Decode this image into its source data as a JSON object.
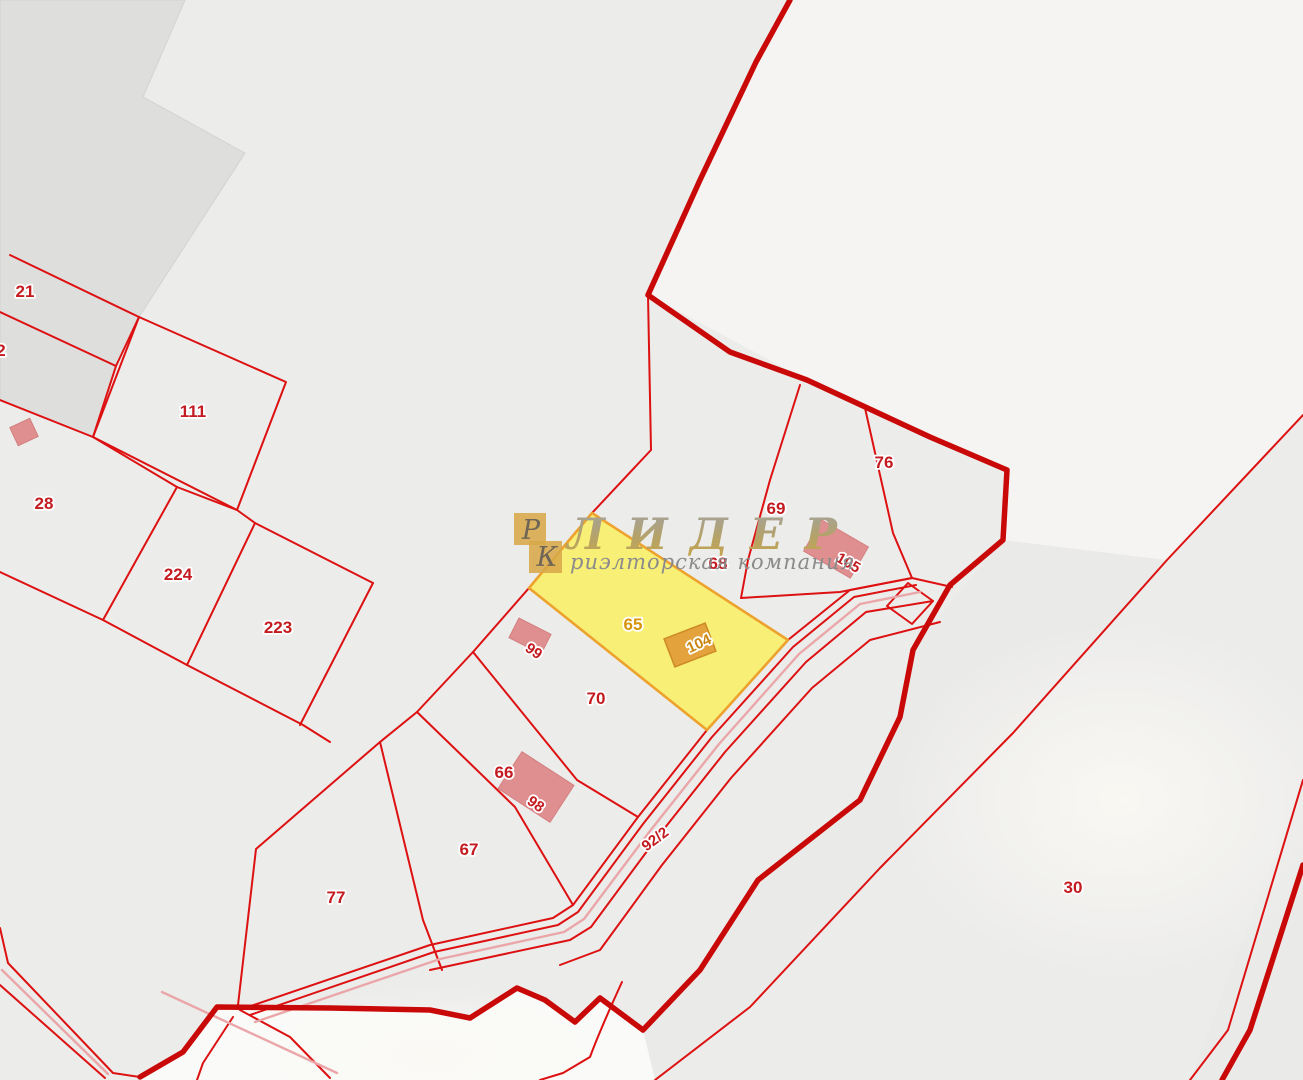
{
  "map": {
    "watermark": {
      "abbr_letter_1": "Р",
      "abbr_letter_2": "К",
      "brand": "ЛИДЕР",
      "subtitle": "риэлторская компания"
    },
    "labels": {
      "p21": "21",
      "p2": "2",
      "p111": "111",
      "p28": "28",
      "p224": "224",
      "p223": "223",
      "p76": "76",
      "p69": "69",
      "p68": "68",
      "p65": "65",
      "p70": "70",
      "p66": "66",
      "p67": "67",
      "p77": "77",
      "p30": "30",
      "b99": "99",
      "b98": "98",
      "b104": "104",
      "b105": "105",
      "road": "92/2"
    },
    "colors": {
      "background": "#ececeb",
      "background_dark": "#dededd",
      "background_light": "#f5f4f2",
      "parcel_line": "#dd1111",
      "boundary_thick": "#c90808",
      "highlight_fill": "#f8ef6d",
      "highlight_stroke": "#eda22d",
      "building_salmon": "#df8f8f",
      "building_orange": "#e3a23b",
      "label_red": "#c31b20",
      "label_orange": "#d69508",
      "road_center_pink": "#eaa6a8",
      "watermark_gold": "#d8a94a"
    }
  }
}
